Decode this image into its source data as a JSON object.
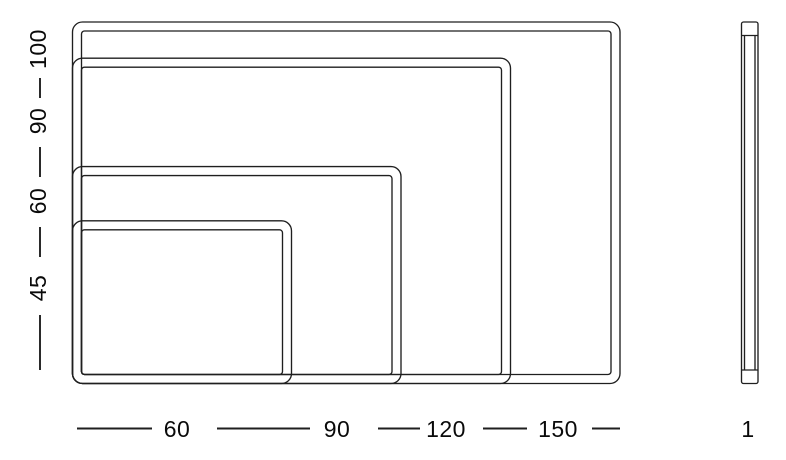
{
  "diagram": {
    "description": "Board size dimension drawing",
    "boards": [
      {
        "width": 150,
        "height": 100
      },
      {
        "width": 120,
        "height": 90
      },
      {
        "width": 90,
        "height": 60
      },
      {
        "width": 60,
        "height": 45
      }
    ],
    "left_axis": {
      "labels": [
        {
          "text": "100"
        },
        {
          "text": "90"
        },
        {
          "text": "60"
        },
        {
          "text": "45"
        }
      ]
    },
    "bottom_axis": {
      "labels": [
        {
          "text": "60"
        },
        {
          "text": "90"
        },
        {
          "text": "120"
        },
        {
          "text": "150"
        }
      ]
    },
    "side_view": {
      "label": {
        "text": "1"
      }
    },
    "colors": {
      "line": "#1f1f1f",
      "text": "#0a0a0a",
      "background": "#ffffff"
    }
  }
}
